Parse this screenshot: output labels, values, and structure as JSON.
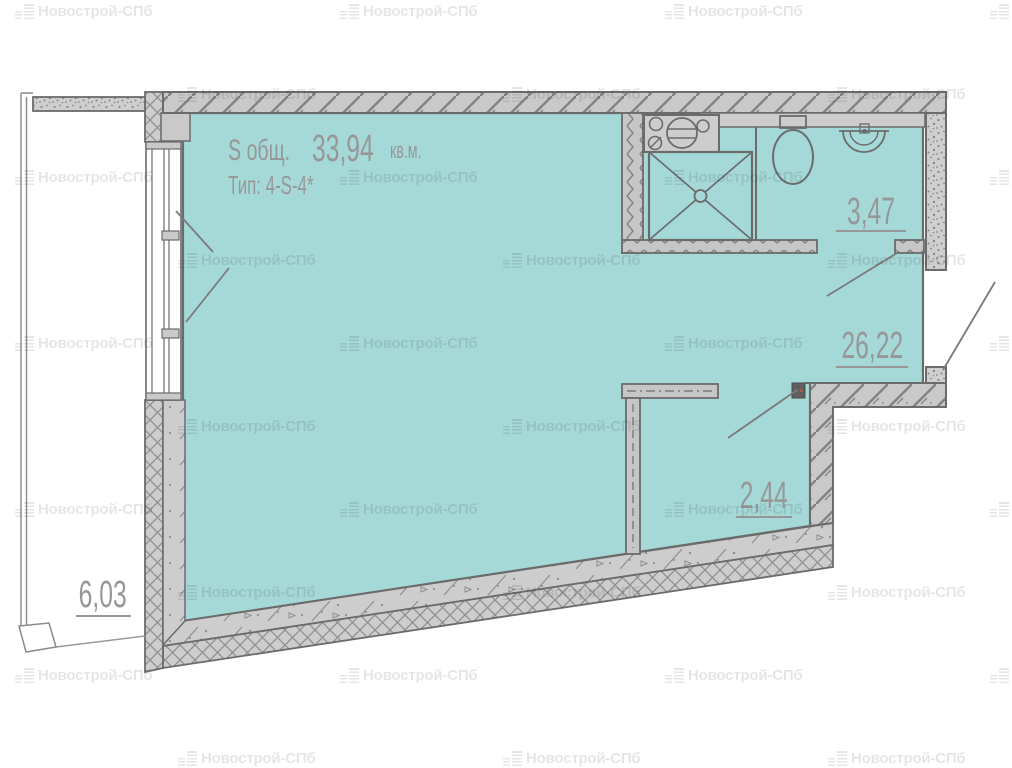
{
  "plan": {
    "title": {
      "s_label": "S общ.",
      "area_value": "33,94",
      "unit": "кв.м.",
      "type_line": "Тип:  4-S-4*"
    },
    "rooms": {
      "bathroom_area": "3,47",
      "living_area": "26,22",
      "hall_area": "2,44",
      "balcony_area": "6,03"
    }
  },
  "watermark": {
    "text": "Новострой-СПб"
  },
  "colors": {
    "floor": "#a5d9d8",
    "wall_fill": "#c9c9c9",
    "wall_line": "#6b6b6b",
    "label": "#979797",
    "outlet_dot": "#c0564a"
  }
}
